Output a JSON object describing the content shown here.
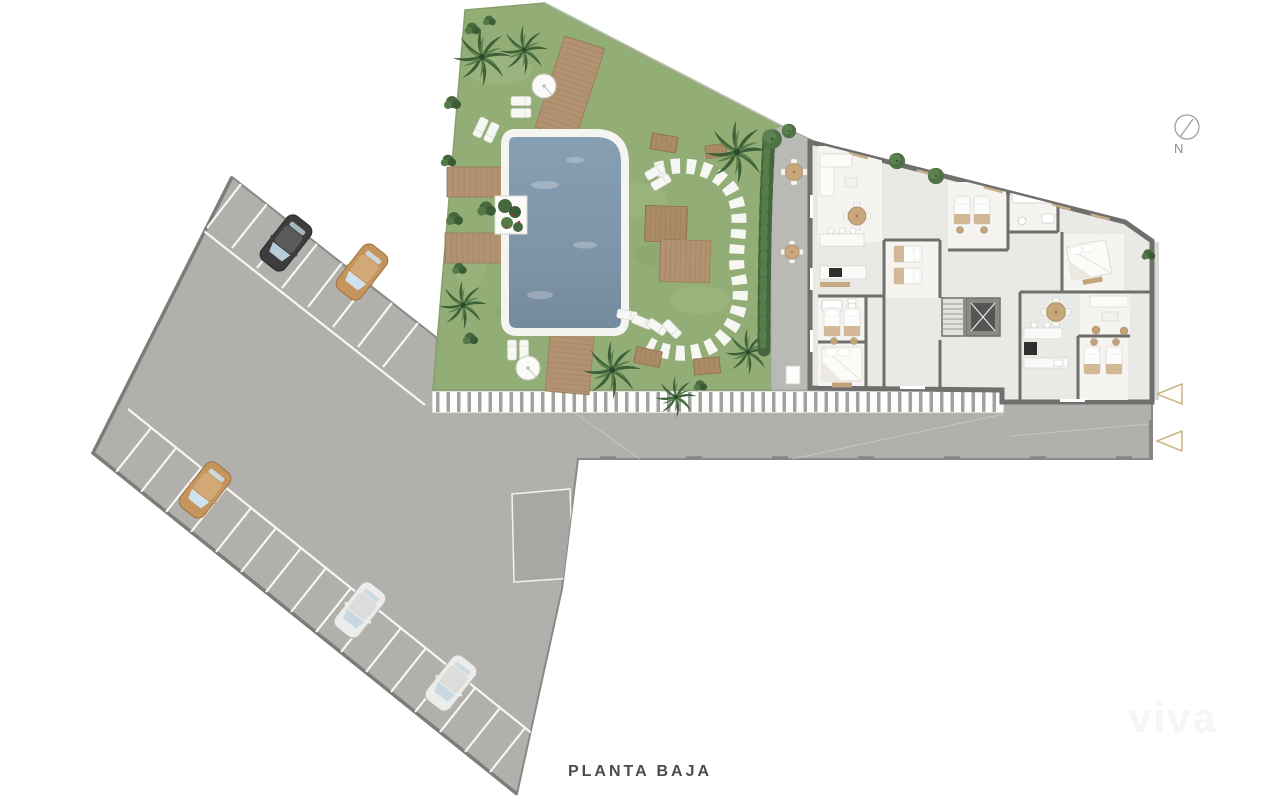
{
  "meta": {
    "title": "PLANTA BAJA",
    "drawing_type": "ground floor site plan"
  },
  "compass": {
    "label": "N"
  },
  "watermark": {
    "text": "viva"
  },
  "entrance_arrows": {
    "count": 2,
    "direction": "left",
    "color": "#cdb68c"
  },
  "site": {
    "areas": [
      "parking-lot",
      "street",
      "pedestrian-crosswalk",
      "garden",
      "swimming-pool",
      "apartment-building",
      "terrace"
    ],
    "parking": {
      "cars": [
        {
          "id": "car-black",
          "color": "#3d3d3d",
          "x": 286,
          "y": 243
        },
        {
          "id": "car-tan-top",
          "color": "#c6955e",
          "x": 362,
          "y": 272
        },
        {
          "id": "car-tan-left",
          "color": "#c6955e",
          "x": 205,
          "y": 490
        },
        {
          "id": "car-silver-upper",
          "color": "#ececea",
          "x": 360,
          "y": 610
        },
        {
          "id": "car-silver-lower",
          "color": "#ececea",
          "x": 451,
          "y": 683
        }
      ]
    },
    "garden_features": [
      "palm-trees",
      "wood-decks",
      "sun-loungers",
      "parasols",
      "planter",
      "stepping-stone-path",
      "hedge"
    ],
    "building_features": [
      "living-rooms",
      "bedrooms",
      "bathrooms",
      "kitchens",
      "elevator",
      "stairs"
    ]
  },
  "palette": {
    "paving_gray": "#b1b0ad",
    "paving_border": "#8a8987",
    "divider_white": "#f7f7f5",
    "grass_green": "#93ad77",
    "pool_blue_light": "#87a0b4",
    "pool_blue_dark": "#74899c",
    "pool_coping": "#f4f4f1",
    "deck_wood": "#b29270",
    "palm_green": "#3c6138",
    "building_floor": "#e9e9e5",
    "room_white": "#f5f4f0",
    "wall_gray": "#6f6f6d",
    "furniture_tan": "#c2a37b",
    "appliance_dark": "#2f2f2d",
    "terrace_gray": "#b9b9b6",
    "title_color": "#4b4b4b"
  }
}
